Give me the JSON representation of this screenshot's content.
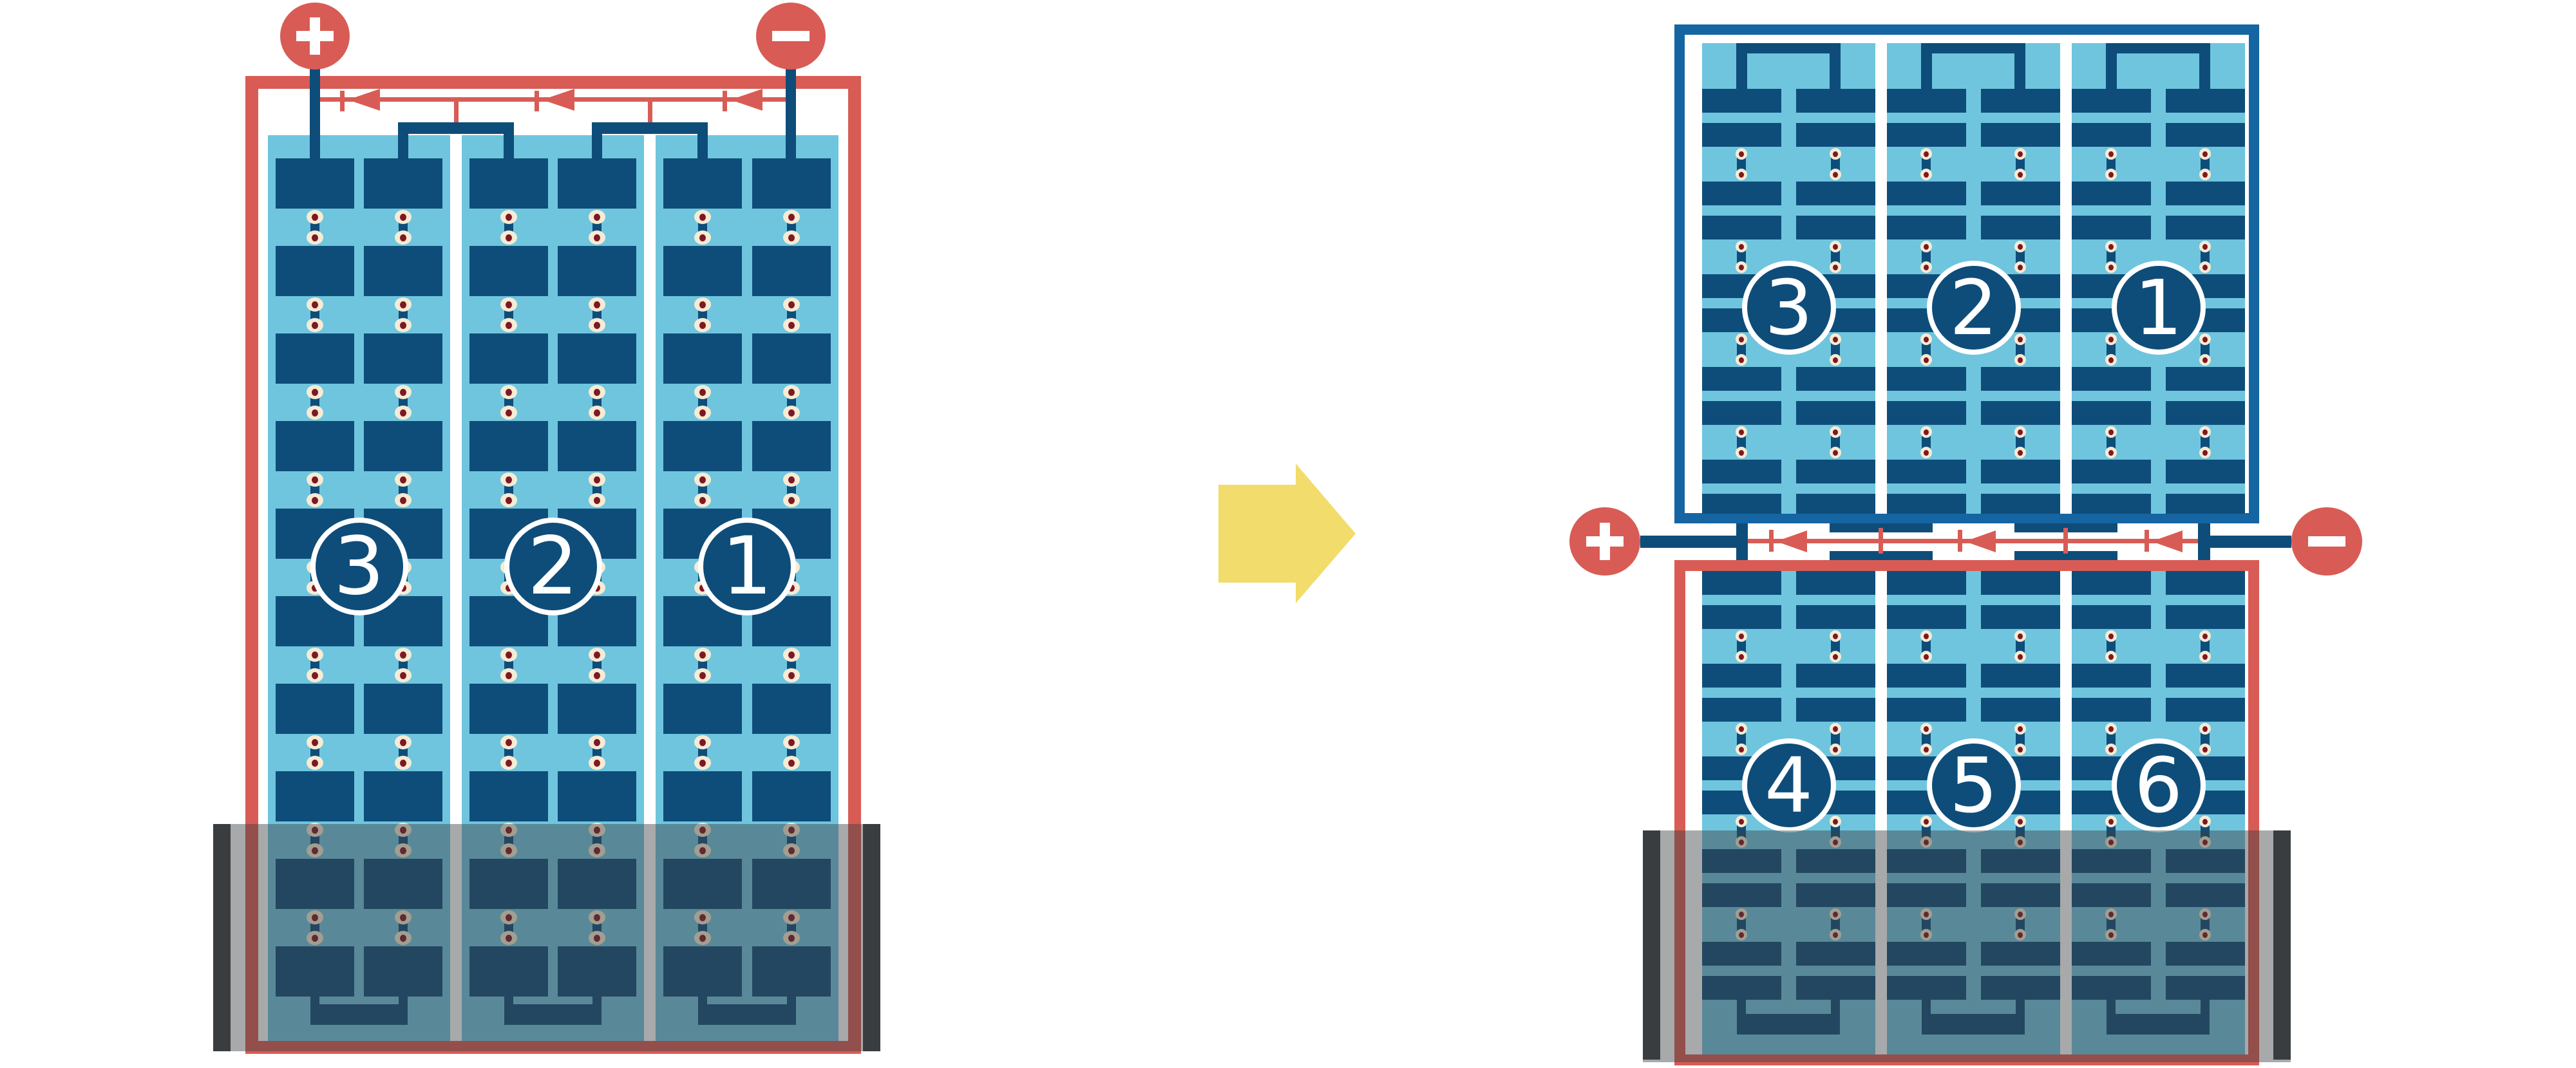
{
  "diagram_type": "lead-acid battery cells in series (3-cell row rearranged into 2 rows of 3 cells)",
  "colors": {
    "red": "#D85C55",
    "navy": "#0E4D79",
    "border_blue": "#1565A3",
    "light_blue": "#6FC5DE",
    "cream": "#F6EBD4",
    "maroon": "#7E1822",
    "yellow": "#F2DC6B",
    "case_dark": "#3A3D3F",
    "case_overlay": "rgba(62,64,66,0.45)",
    "white": "#FFFFFF"
  },
  "left_battery": {
    "cell_labels": [
      "3",
      "2",
      "1"
    ],
    "positive_terminal_sign": "+",
    "negative_terminal_sign": "−",
    "current_arrow_count": 3,
    "current_direction": "left"
  },
  "right_battery": {
    "top_row_cell_labels": [
      "3",
      "2",
      "1"
    ],
    "bottom_row_cell_labels": [
      "4",
      "5",
      "6"
    ],
    "positive_terminal_sign": "+",
    "negative_terminal_sign": "−",
    "current_arrow_count": 3,
    "current_direction": "left"
  },
  "transform_arrow": {
    "direction": "right"
  }
}
